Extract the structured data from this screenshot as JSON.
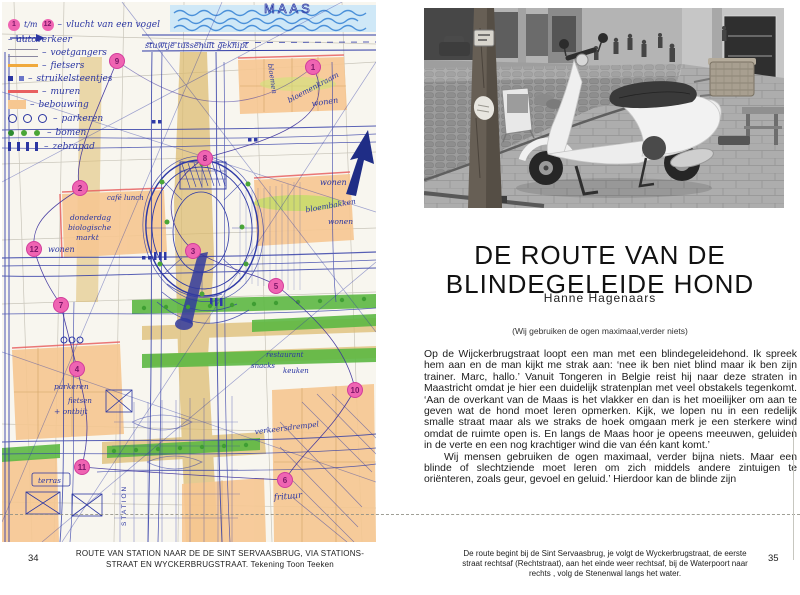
{
  "left": {
    "page_number": "34",
    "caption_line1": "ROUTE VAN STATION NAAR DE DE SINT SERVAASBRUG, VIA STATIONS-",
    "caption_line2": "STRAAT EN WYCKERBRUGSTRAAT. Tekening Toon Teeken",
    "map": {
      "title": "MAAS",
      "note": "stuwtje tussenuit geknipt",
      "legend_range": {
        "start": "1",
        "sep": "t/m",
        "end": "12"
      },
      "legend_dash": "–",
      "legend": [
        "vlucht van een vogel",
        "autoverkeer",
        "voetgangers",
        "fietsers",
        "struikelsteentjes",
        "muren",
        "bebouwing",
        "parkeren",
        "bomen",
        "zebrapad"
      ],
      "numbers": [
        "1",
        "2",
        "3",
        "4",
        "5",
        "6",
        "7",
        "8",
        "9",
        "10",
        "11",
        "12"
      ],
      "labels": [
        "bloemenkraam",
        "wonen",
        "wonen",
        "bloembakken",
        "wonen",
        "donderdag",
        "biologische",
        "markt",
        "wonen",
        "café lunch",
        "parkeren",
        "fietsen",
        "+ ontbijt",
        "STATION",
        "verkeersdrempel",
        "restaurant",
        "snacks",
        "keuken",
        "frituur",
        "terras",
        "bloemen"
      ]
    }
  },
  "right": {
    "page_number": "35",
    "title_line1": "DE ROUTE VAN DE",
    "title_line2": "BLINDEGELEIDE HOND",
    "author": "Hanne Hagenaars",
    "subtitle": "(Wij gebruiken de ogen maximaal,verder niets)",
    "paragraphs": [
      "Op de Wijckerbrugstraat loopt een man met een blindegeleidehond. Ik spreek hem aan en de man kijkt me strak aan: ‘nee ik ben niet blind maar ik ben zijn trainer. Marc, hallo.’ Vanuit Tongeren in Belgie reist hij naar deze straten in Maastricht omdat je hier een duidelijk stratenplan met veel obstakels tegenkomt.  ‘Aan de overkant van de Maas is het vlakker en dan is het moeilijker om aan te geven wat de hond moet leren opmerken. Kijk, we lopen nu in een redelijk smalle straat maar als we straks de hoek omgaan merk je een sterkere wind omdat de ruimte open is. En langs de Maas hoor je opeens meeuwen, geluiden in de verte en een nog krachtiger wind die van één kant komt.’",
      "Wij mensen gebruiken de ogen maximaal, verder bijna niets. Maar een blinde of slechtziende moet leren om zich middels andere zintuigen te oriënteren, zoals geur, gevoel en geluid.’ Hierdoor kan de blinde zijn"
    ],
    "footnote_line1": "De route begint bij de Sint Servaasbrug, je volgt de Wyckerbrugstraat, de eerste",
    "footnote_line2": "straat rechtsaf (Rechtstraat), aan het einde weer rechtsaf, bij de Waterpoort naar",
    "footnote_line3": "rechts , volg de Stenenwal langs het water."
  }
}
